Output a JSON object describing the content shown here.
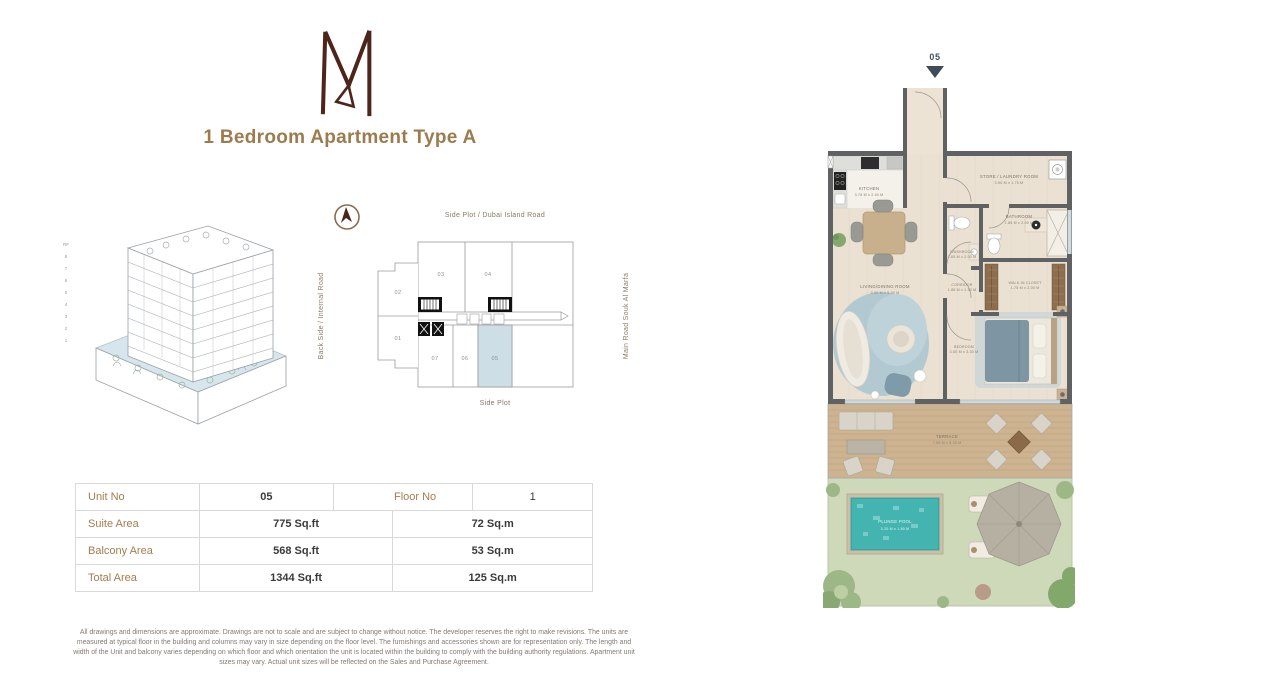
{
  "header": {
    "title": "1 Bedroom Apartment  Type A"
  },
  "accent_colors": {
    "title_brown": "#9c7b4c",
    "logo_maroon": "#4e251b",
    "unit_highlight": "#cddee6",
    "pool_teal": "#44b4b1"
  },
  "building": {
    "floors": [
      "RF",
      "8",
      "7",
      "6",
      "5",
      "4",
      "3",
      "2",
      "1"
    ]
  },
  "key_plan": {
    "road_top": "Side Plot / Dubai Island Road",
    "road_left": "Back Side / Internal Road",
    "road_right": "Main Road Souk Al Marfa",
    "road_bottom": "Side Plot",
    "units": {
      "u01": "01",
      "u02": "02",
      "u03": "03",
      "u04": "04",
      "u05": "05",
      "u06": "06",
      "u07": "07"
    },
    "highlighted_unit": "05"
  },
  "info_table": {
    "row1": {
      "label1": "Unit No",
      "value1": "05",
      "label2": "Floor No",
      "value2": "1"
    },
    "rows": [
      {
        "label": "Suite Area",
        "sqft": "775 Sq.ft",
        "sqm": "72 Sq.m"
      },
      {
        "label": "Balcony Area",
        "sqft": "568 Sq.ft",
        "sqm": "53 Sq.m"
      },
      {
        "label": "Total Area",
        "sqft": "1344 Sq.ft",
        "sqm": "125 Sq.m"
      }
    ]
  },
  "floor_plan": {
    "unit_marker": "05",
    "rooms": {
      "kitchen": {
        "name": "KITCHEN",
        "dims": "3.78 M x 2.40 M"
      },
      "store": {
        "name": "STORE / LAUNDRY ROOM",
        "dims": "3.90 M x 1.75 M"
      },
      "bathroom": {
        "name": "BATHROOM",
        "dims": "1.85 M x 2.00 M"
      },
      "washroom": {
        "name": "WASHROOM",
        "dims": "1.65 M x 2.00 M"
      },
      "corridor": {
        "name": "CORRIDOR",
        "dims": "1.85 M x 1.50 M"
      },
      "closet": {
        "name": "WALK-IN CLOSET",
        "dims": "1.75 M x 2.00 M"
      },
      "living": {
        "name": "LIVING/DINING ROOM",
        "dims": "3.90 M x 5.90 M"
      },
      "bedroom": {
        "name": "BEDROOM",
        "dims": "3.50 M x 3.30 M"
      },
      "terrace": {
        "name": "TERRACE",
        "dims": "7.95 M x 6.30 M"
      },
      "pool": {
        "name": "PLUNGE POOL",
        "dims": "3.20 M x 1.80 M"
      }
    }
  },
  "disclaimer": "All drawings and dimensions are approximate. Drawings are not to scale and are subject to change without notice. The developer reserves the right to make revisions. The units are measured at typical floor in the building and columns may vary in size depending on the floor level. The furnishings and accessories shown are for representation only. The length and width of the Unit and balcony varies depending on which floor and which orientation the unit is located within the building to  comply with the building authority regulations. Apartment unit sizes may vary. Actual unit sizes will be reflected on the Sales and Purchase Agreement."
}
